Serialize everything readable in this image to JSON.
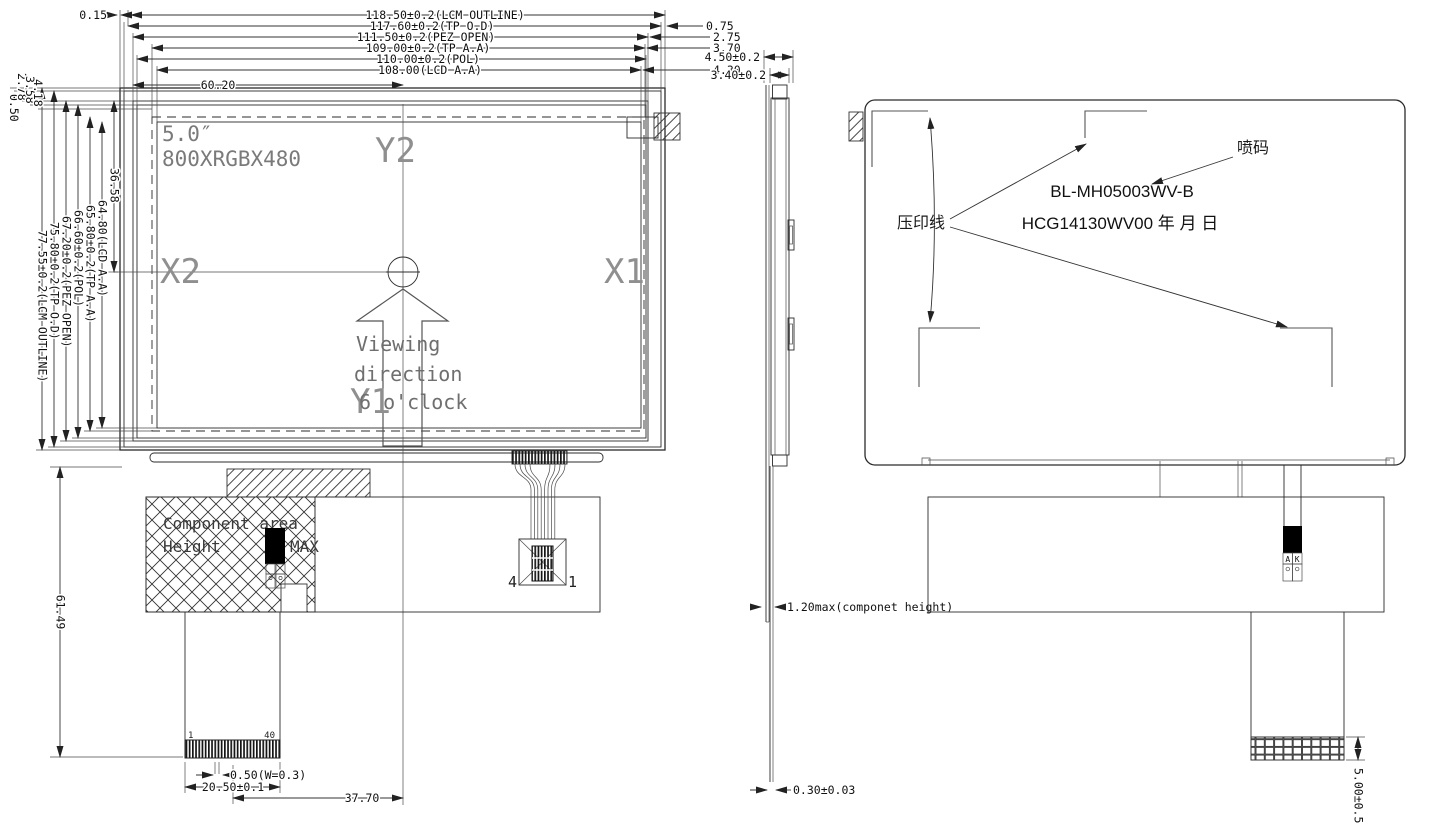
{
  "front": {
    "dim015": "0.15",
    "top_dims": [
      "118.50±0.2(LCM OUTLINE)",
      "117.60±0.2(TP O.D)",
      "111.50±0.2(PEZ OPEN)",
      "109.00±0.2(TP A.A)",
      "110.00±0.2(POL)",
      "108.00(LCD A.A)"
    ],
    "dim6020": "60.20",
    "right_offsets": [
      "0.75",
      "2.75",
      "3.70",
      "4.30"
    ],
    "left_offsets": [
      "0.50",
      "2.78",
      "3.58",
      "4.18"
    ],
    "left_dims": [
      "77.55±0.2(LCM OUTLINE)",
      "75.80±0.2(TP O.D)",
      "67.20±0.2(PEZ OPEN)",
      "66.60±0.2(POL)",
      "65.80±0.2(TP A.A)",
      "64.80(LCD A.A)"
    ],
    "dim3658": "36.58",
    "size_label": "5.0″",
    "resolution": "800XRGBX480",
    "axes": {
      "x1": "X1",
      "x2": "X2",
      "y1": "Y1",
      "y2": "Y2"
    },
    "viewing": [
      "Viewing",
      "direction",
      "6 o'clock"
    ],
    "comp_area": {
      "line1": "Component area",
      "line2a": "Height",
      "line2b": "MAX"
    },
    "pins": {
      "first": "1",
      "last": "40"
    },
    "fpc4": {
      "left": "4",
      "right": "1"
    },
    "dim_pin": "0.50(W=0.3)",
    "dim_conn": "20.50±0.1",
    "dim3770": "37.70",
    "dim6149": "61.49"
  },
  "side": {
    "dim450": "4.50±0.2",
    "dim340": "3.40±0.2",
    "dim120": "1.20max(componet height)",
    "dim030": "0.30±0.03"
  },
  "back": {
    "stamp_line": "压印线",
    "inkjet": "喷码",
    "model1": "BL-MH05003WV-B",
    "model2": "HCG14130WV00  年 月 日",
    "conn_a": "A",
    "conn_k": "K",
    "dim500": "5.00±0.5"
  }
}
